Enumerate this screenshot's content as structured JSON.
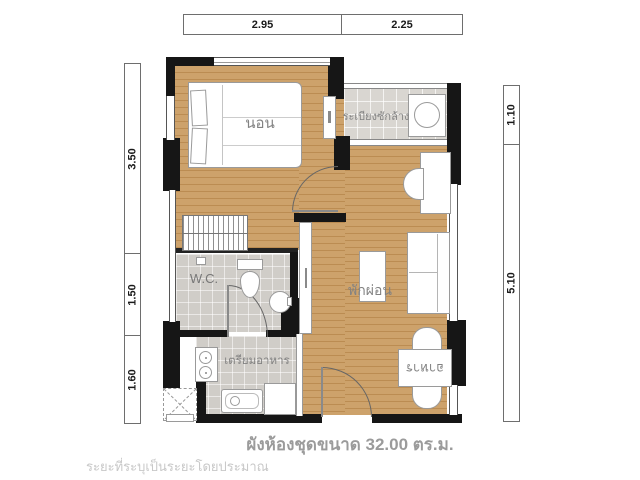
{
  "dimension_bars": {
    "top": {
      "segments": [
        {
          "value": "2.95"
        },
        {
          "value": "2.25"
        }
      ]
    },
    "left": {
      "segments": [
        {
          "value": "3.50"
        },
        {
          "value": "1.50"
        },
        {
          "value": "1.60"
        }
      ]
    },
    "right": {
      "segments": [
        {
          "value": "1.10"
        },
        {
          "value": "5.10"
        }
      ]
    }
  },
  "rooms": {
    "bedroom": {
      "label": "นอน"
    },
    "laundry_balcony": {
      "label": "ระเบียงซักล้าง"
    },
    "wc": {
      "label": "W.C."
    },
    "living": {
      "label": "พักผ่อน"
    },
    "kitchen": {
      "label": "เตรียมอาหาร"
    },
    "dining": {
      "label": "อาหาร"
    }
  },
  "caption": {
    "text": "ผังห้องชุดขนาด 32.00 ตร.ม."
  },
  "disclaimer": {
    "text": "ระยะที่ระบุเป็นระยะโดยประมาณ"
  },
  "colors": {
    "wall": "#161616",
    "wood_floor": "#c99e67",
    "balcony_tile": "#d9d6d1",
    "wet_area_tile": "#d0cdc8",
    "furniture_outline": "#9a9a9a",
    "label_text": "#828282",
    "caption_text": "#9b9b9b",
    "disclaimer_text": "#c8c8c8"
  }
}
